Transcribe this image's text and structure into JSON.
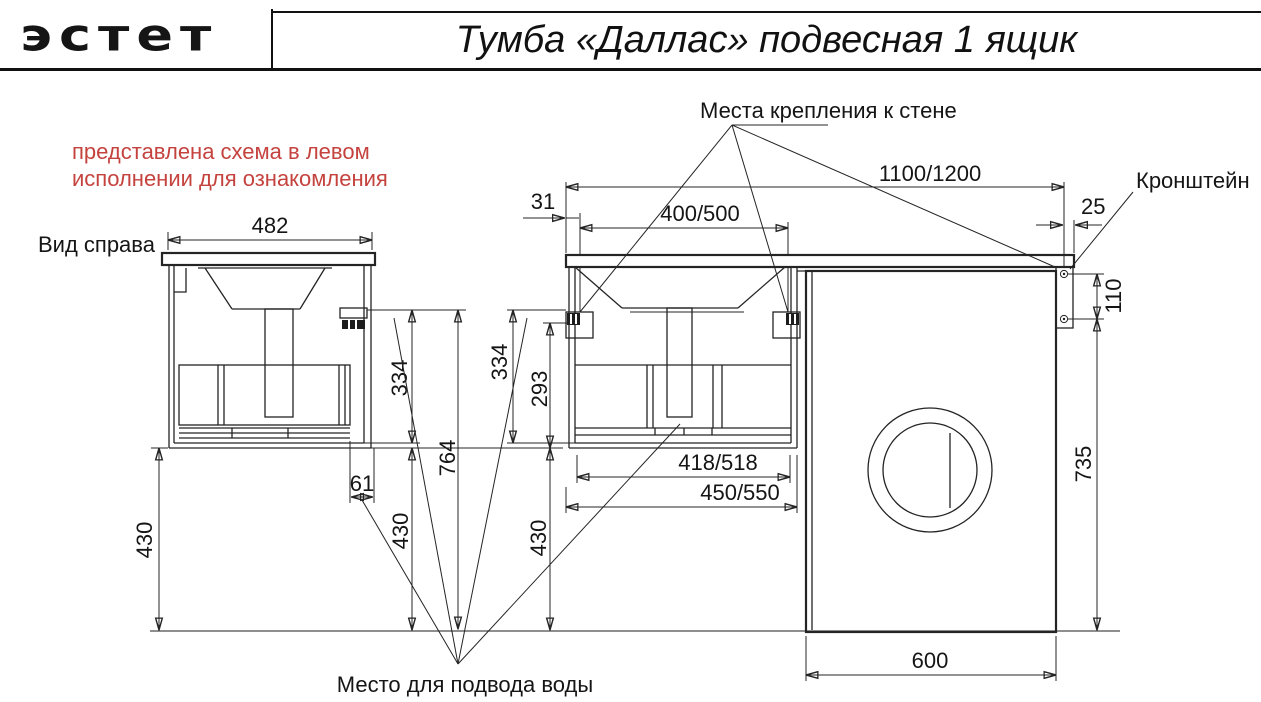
{
  "header": {
    "logo_text": "эстет",
    "title": "Тумба «Даллас» подвесная 1 ящик"
  },
  "note": {
    "line1": "представлена схема в левом",
    "line2": "исполнении для ознакомления",
    "color": "#c5433f"
  },
  "labels": {
    "side_view": "Вид справа",
    "wall_mounts": "Места крепления к стене",
    "bracket": "Кронштейн",
    "water_supply": "Место для подвода воды"
  },
  "dims": {
    "side_depth": "482",
    "edge_offset": "31",
    "mount_spacing": "400/500",
    "overall_width": "1100/1200",
    "bracket_edge": "25",
    "bracket_holes": "110",
    "side_mount_height": "334",
    "front_mount_height": "334",
    "inner_height": "293",
    "mount_floor_height": "764",
    "drain_offset": "61",
    "floor_clearance_left": "430",
    "floor_clearance_side": "430",
    "floor_clearance_front": "430",
    "drawer_width": "418/518",
    "body_width": "450/550",
    "machine_height": "735",
    "machine_width": "600"
  },
  "colors": {
    "line": "#242424",
    "note_red": "#c5433f",
    "floor": "#4a4a4a"
  }
}
